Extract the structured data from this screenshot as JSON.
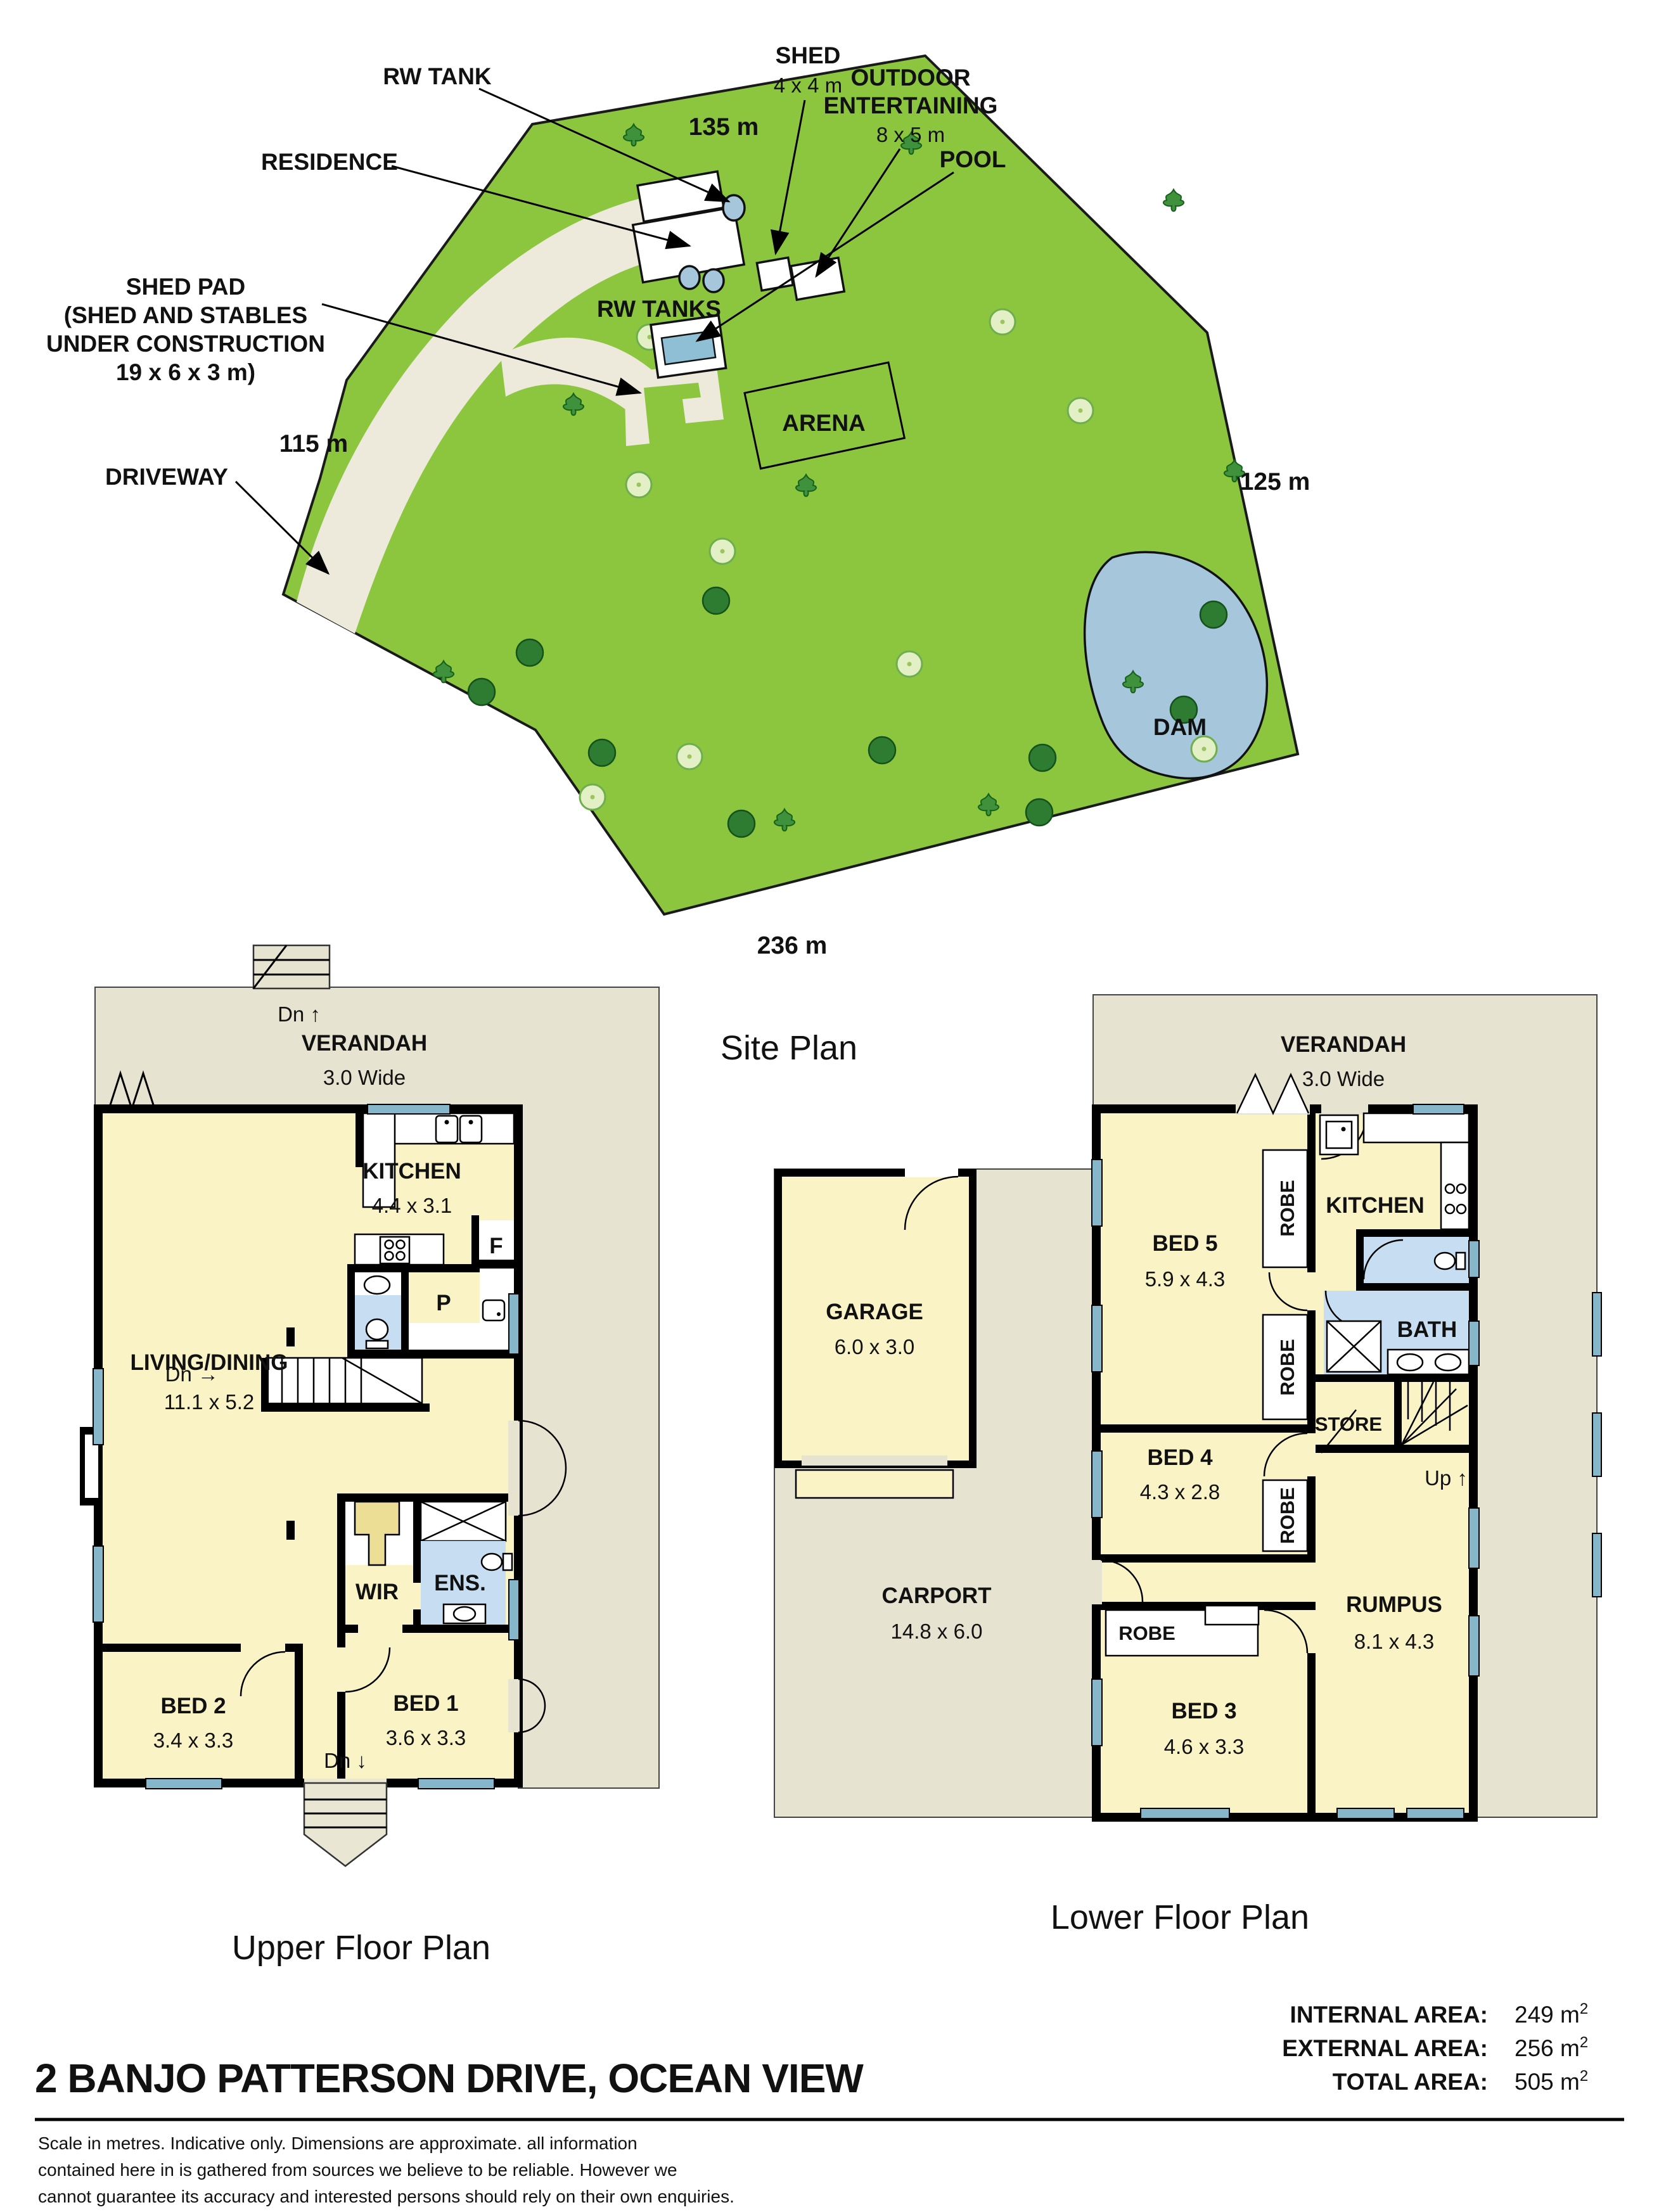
{
  "site_plan": {
    "caption": "Site Plan",
    "boundaries": {
      "top": "135 m",
      "right": "125 m",
      "bottom": "236 m",
      "left": "115 m"
    },
    "labels": {
      "rw_tank": "RW TANK",
      "residence": "RESIDENCE",
      "shed": "SHED",
      "shed_dims": "4 x 4 m",
      "outdoor_1": "OUTDOOR",
      "outdoor_2": "ENTERTAINING",
      "outdoor_dims": "8 x 5 m",
      "pool": "POOL",
      "shed_pad_lines": [
        "SHED PAD",
        "(SHED AND STABLES",
        "UNDER CONSTRUCTION",
        "19 x 6 x 3 m)"
      ],
      "driveway": "DRIVEWAY",
      "rw_tanks": "RW TANKS",
      "arena": "ARENA",
      "dam": "DAM"
    }
  },
  "upper_plan": {
    "caption": "Upper Floor Plan",
    "stairs_top": "Dn ↑",
    "stairs_mid": "Dn →",
    "stairs_bottom": "Dn ↓",
    "rooms": {
      "verandah": {
        "name": "VERANDAH",
        "dims": "3.0 Wide"
      },
      "kitchen": {
        "name": "KITCHEN",
        "dims": "4.4 x 3.1"
      },
      "living": {
        "name": "LIVING/DINING",
        "dims": "11.1 x 5.2"
      },
      "wir": {
        "name": "WIR"
      },
      "ens": {
        "name": "ENS."
      },
      "bed2": {
        "name": "BED 2",
        "dims": "3.4 x 3.3"
      },
      "bed1": {
        "name": "BED 1",
        "dims": "3.6 x 3.3"
      },
      "fridge": "F",
      "pantry": "P"
    }
  },
  "lower_plan": {
    "caption": "Lower Floor Plan",
    "stairs": "Up ↑",
    "rooms": {
      "verandah": {
        "name": "VERANDAH",
        "dims": "3.0 Wide"
      },
      "garage": {
        "name": "GARAGE",
        "dims": "6.0 x 3.0"
      },
      "carport": {
        "name": "CARPORT",
        "dims": "14.8 x 6.0"
      },
      "bed5": {
        "name": "BED 5",
        "dims": "5.9 x 4.3"
      },
      "bed4": {
        "name": "BED 4",
        "dims": "4.3 x 2.8"
      },
      "bed3": {
        "name": "BED 3",
        "dims": "4.6 x 3.3"
      },
      "rumpus": {
        "name": "RUMPUS",
        "dims": "8.1 x 4.3"
      },
      "kitchen": {
        "name": "KITCHEN"
      },
      "bath": {
        "name": "BATH"
      },
      "store": {
        "name": "STORE"
      },
      "robe": "ROBE"
    }
  },
  "footer": {
    "address": "2 BANJO PATTERSON DRIVE, OCEAN VIEW",
    "areas": [
      {
        "label": "INTERNAL AREA:",
        "value": "249 m",
        "sup": "2"
      },
      {
        "label": "EXTERNAL AREA:",
        "value": "256 m",
        "sup": "2"
      },
      {
        "label": "TOTAL AREA:",
        "value": "505 m",
        "sup": "2"
      }
    ],
    "disclaimer_lines": [
      "Scale in metres. Indicative only. Dimensions are approximate. all information",
      "contained here in is gathered from sources we believe to be reliable. However we",
      "cannot guarantee its accuracy and interested persons should rely on their own enquiries."
    ]
  },
  "colors": {
    "grass": "#8CC63F",
    "driveway": "#EDEADB",
    "verandah": "#E7E3D1",
    "room_yellow": "#FAF3C6",
    "wet_blue": "#C7DEF2",
    "window_blue": "#85B6C9",
    "water_blue": "#A5C6DB",
    "wall_black": "#000000"
  }
}
